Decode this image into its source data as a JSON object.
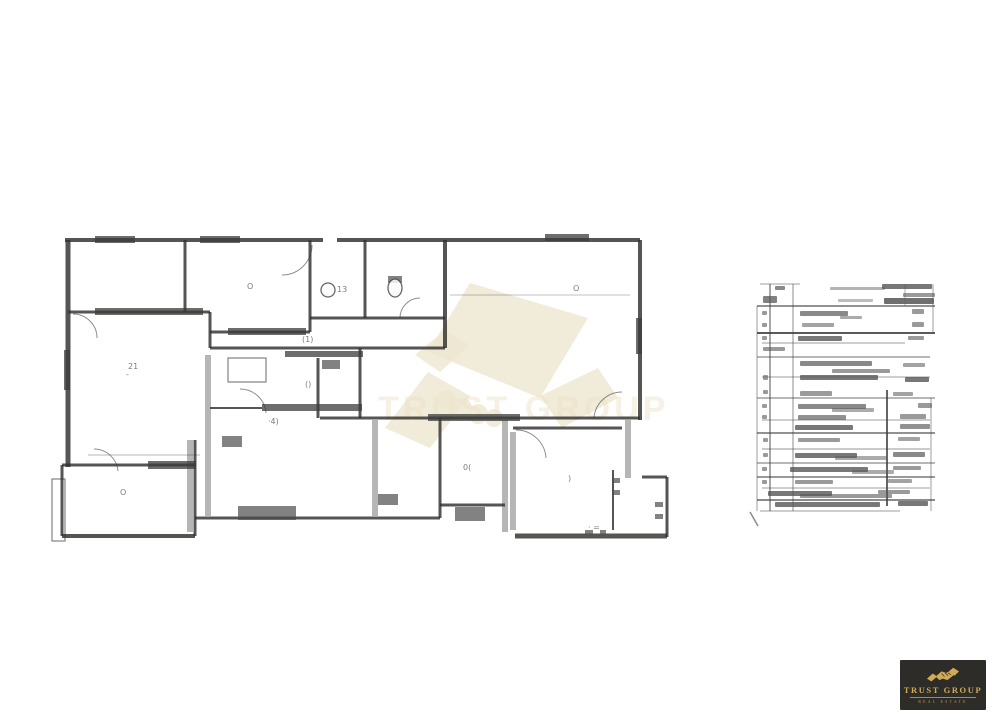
{
  "page": {
    "background": "#ffffff"
  },
  "logo": {
    "title": "TRUST GROUP",
    "subtitle": "REAL ESTATE",
    "bg": "#2d2c29",
    "gold": "#d2a955"
  },
  "watermark": {
    "color": "#f3ecd6",
    "text": "TRUST GROUP",
    "text_color": "#f0e5c6",
    "text_opacity": 0.45,
    "shape_opacity": 0.85,
    "polys": [
      [
        [
          470,
          283
        ],
        [
          588,
          318
        ],
        [
          540,
          398
        ],
        [
          428,
          352
        ]
      ],
      [
        [
          385,
          428
        ],
        [
          428,
          372
        ],
        [
          470,
          396
        ],
        [
          430,
          448
        ]
      ],
      [
        [
          540,
          396
        ],
        [
          598,
          368
        ],
        [
          618,
          398
        ],
        [
          562,
          428
        ]
      ],
      [
        [
          415,
          355
        ],
        [
          445,
          330
        ],
        [
          470,
          345
        ],
        [
          440,
          372
        ]
      ]
    ],
    "circles": [
      [
        447,
        400,
        10
      ],
      [
        462,
        408,
        10
      ],
      [
        478,
        414,
        10
      ],
      [
        494,
        418,
        9
      ]
    ]
  },
  "floor_plan": {
    "ink": "#2f2d2b",
    "gray": "#8f8f8f",
    "band_color": "#3a3a3a",
    "fixture_color": "#4a4a4a",
    "label_color": "#5a5a5a",
    "walls": [
      [
        65,
        240,
        323,
        240,
        4
      ],
      [
        337,
        240,
        640,
        240,
        4
      ],
      [
        640,
        240,
        640,
        420,
        4
      ],
      [
        320,
        418,
        640,
        418,
        3
      ],
      [
        513,
        428,
        622,
        428,
        3
      ],
      [
        642,
        477,
        667,
        477,
        3
      ],
      [
        667,
        477,
        667,
        537,
        3
      ],
      [
        515,
        536,
        667,
        536,
        5
      ],
      [
        613,
        470,
        613,
        530,
        2
      ],
      [
        195,
        518,
        440,
        518,
        3
      ],
      [
        440,
        505,
        505,
        505,
        3
      ],
      [
        440,
        418,
        440,
        518,
        3
      ],
      [
        68,
        240,
        68,
        467,
        5
      ],
      [
        62,
        465,
        195,
        465,
        3
      ],
      [
        62,
        465,
        62,
        536,
        3
      ],
      [
        62,
        536,
        195,
        536,
        4
      ],
      [
        195,
        440,
        195,
        536,
        3
      ],
      [
        185,
        240,
        185,
        312,
        3
      ],
      [
        68,
        312,
        210,
        312,
        3
      ],
      [
        210,
        312,
        210,
        348,
        3
      ],
      [
        310,
        240,
        310,
        332,
        3
      ],
      [
        210,
        332,
        310,
        332,
        3
      ],
      [
        365,
        240,
        365,
        318,
        3
      ],
      [
        310,
        318,
        365,
        318,
        3
      ],
      [
        365,
        318,
        445,
        318,
        3
      ],
      [
        445,
        240,
        445,
        348,
        4
      ],
      [
        210,
        348,
        445,
        348,
        3
      ],
      [
        318,
        358,
        318,
        418,
        3
      ],
      [
        360,
        348,
        360,
        418,
        3
      ],
      [
        210,
        408,
        262,
        408,
        2
      ],
      [
        450,
        295,
        630,
        295,
        1,
        0.3
      ],
      [
        88,
        455,
        200,
        455,
        1,
        0.35
      ]
    ],
    "gray_walls": [
      [
        208,
        355,
        208,
        516
      ],
      [
        375,
        420,
        375,
        516
      ],
      [
        505,
        420,
        505,
        532
      ],
      [
        513,
        432,
        513,
        530
      ],
      [
        628,
        420,
        628,
        478
      ],
      [
        190,
        440,
        190,
        532
      ]
    ],
    "bands": [
      [
        95,
        236,
        40,
        7
      ],
      [
        200,
        236,
        40,
        7
      ],
      [
        545,
        234,
        44,
        7
      ],
      [
        95,
        308,
        108,
        7
      ],
      [
        228,
        328,
        78,
        7
      ],
      [
        285,
        351,
        78,
        6
      ],
      [
        262,
        404,
        100,
        7
      ],
      [
        428,
        414,
        92,
        7
      ],
      [
        148,
        461,
        48,
        8
      ],
      [
        64,
        350,
        6,
        40
      ],
      [
        636,
        318,
        6,
        36
      ]
    ],
    "fixtures": [
      [
        238,
        506,
        58,
        14
      ],
      [
        455,
        507,
        30,
        14
      ],
      [
        378,
        494,
        20,
        11
      ],
      [
        222,
        436,
        20,
        11
      ],
      [
        388,
        276,
        14,
        7
      ],
      [
        322,
        360,
        18,
        9
      ],
      [
        612,
        478,
        8,
        5
      ],
      [
        612,
        490,
        8,
        5
      ],
      [
        655,
        502,
        8,
        5
      ],
      [
        655,
        514,
        8,
        5
      ],
      [
        585,
        530,
        8,
        4
      ],
      [
        600,
        530,
        6,
        4
      ]
    ],
    "ellipses": [
      [
        395,
        288,
        7,
        9
      ],
      [
        328,
        290,
        7,
        7
      ]
    ],
    "outline_rects": [
      [
        52,
        479,
        13,
        62
      ],
      [
        228,
        358,
        38,
        24
      ]
    ],
    "arcs": [
      [
        312,
        245,
        282,
        275,
        30
      ],
      [
        73,
        314,
        97,
        338,
        24
      ],
      [
        240,
        389,
        266,
        413,
        26
      ],
      [
        400,
        318,
        420,
        298,
        20
      ],
      [
        516,
        430,
        546,
        458,
        30
      ],
      [
        594,
        418,
        622,
        392,
        28
      ],
      [
        94,
        449,
        118,
        471,
        24
      ]
    ],
    "labels": [
      {
        "x": 128,
        "y": 369,
        "t": "21"
      },
      {
        "x": 126,
        "y": 377,
        "t": "-"
      },
      {
        "x": 247,
        "y": 289,
        "t": "O"
      },
      {
        "x": 337,
        "y": 292,
        "t": "13"
      },
      {
        "x": 573,
        "y": 291,
        "t": "O"
      },
      {
        "x": 463,
        "y": 470,
        "t": "0("
      },
      {
        "x": 568,
        "y": 481,
        "t": ")"
      },
      {
        "x": 120,
        "y": 495,
        "t": "O"
      },
      {
        "x": 305,
        "y": 387,
        "t": "()"
      },
      {
        "x": 268,
        "y": 424,
        "t": "·4)"
      },
      {
        "x": 588,
        "y": 530,
        "t": "· ="
      },
      {
        "x": 302,
        "y": 342,
        "t": "(1)"
      }
    ]
  },
  "legend_table": {
    "line_color": "#3c3c3c",
    "bar_color": "#555555",
    "h_rules": [
      [
        284,
        760,
        800,
        1,
        0.5
      ],
      [
        306,
        757,
        935,
        1.5,
        0.75
      ],
      [
        333,
        757,
        935,
        2,
        0.85
      ],
      [
        343,
        762,
        905,
        1,
        0.5
      ],
      [
        357,
        757,
        930,
        1.2,
        0.6
      ],
      [
        377,
        762,
        930,
        1,
        0.5
      ],
      [
        398,
        757,
        935,
        1.2,
        0.6
      ],
      [
        420,
        762,
        930,
        1,
        0.5
      ],
      [
        433,
        757,
        935,
        1.5,
        0.75
      ],
      [
        449,
        762,
        930,
        1,
        0.55
      ],
      [
        463,
        757,
        935,
        1.2,
        0.6
      ],
      [
        477,
        757,
        935,
        1.5,
        0.7
      ],
      [
        488,
        762,
        930,
        1,
        0.5
      ],
      [
        500,
        757,
        935,
        1.5,
        0.8
      ],
      [
        511,
        760,
        900,
        1,
        0.5
      ]
    ],
    "v_rules": [
      [
        757,
        306,
        511,
        1,
        0.5
      ],
      [
        770,
        284,
        511,
        1.3,
        0.7
      ],
      [
        793,
        284,
        511,
        1,
        0.6
      ],
      [
        887,
        390,
        506,
        2,
        0.8
      ],
      [
        933,
        284,
        333,
        1,
        0.5
      ],
      [
        931,
        398,
        511,
        1,
        0.5
      ],
      [
        905,
        284,
        306,
        1,
        0.4
      ]
    ],
    "bars": [
      [
        775,
        286,
        10,
        4,
        0.7
      ],
      [
        830,
        287,
        55,
        3,
        0.45
      ],
      [
        882,
        284,
        50,
        5,
        0.8
      ],
      [
        903,
        293,
        32,
        4,
        0.6
      ],
      [
        763,
        296,
        14,
        7,
        0.75
      ],
      [
        838,
        299,
        35,
        3,
        0.4
      ],
      [
        884,
        298,
        50,
        6,
        0.85
      ],
      [
        800,
        311,
        48,
        5,
        0.7
      ],
      [
        840,
        316,
        22,
        3,
        0.5
      ],
      [
        912,
        309,
        12,
        5,
        0.6
      ],
      [
        802,
        323,
        32,
        4,
        0.55
      ],
      [
        912,
        322,
        12,
        5,
        0.6
      ],
      [
        798,
        336,
        44,
        5,
        0.8
      ],
      [
        908,
        336,
        16,
        4,
        0.6
      ],
      [
        763,
        347,
        22,
        4,
        0.6
      ],
      [
        800,
        361,
        72,
        5,
        0.7
      ],
      [
        832,
        369,
        58,
        4,
        0.6
      ],
      [
        903,
        363,
        22,
        4,
        0.55
      ],
      [
        800,
        375,
        78,
        5,
        0.8
      ],
      [
        905,
        377,
        24,
        5,
        0.8
      ],
      [
        800,
        391,
        32,
        5,
        0.6
      ],
      [
        893,
        392,
        20,
        4,
        0.55
      ],
      [
        798,
        404,
        68,
        5,
        0.7
      ],
      [
        832,
        408,
        42,
        4,
        0.5
      ],
      [
        918,
        403,
        14,
        5,
        0.6
      ],
      [
        798,
        415,
        48,
        5,
        0.65
      ],
      [
        900,
        414,
        26,
        5,
        0.6
      ],
      [
        795,
        425,
        58,
        5,
        0.8
      ],
      [
        900,
        424,
        30,
        5,
        0.65
      ],
      [
        798,
        438,
        42,
        4,
        0.6
      ],
      [
        898,
        437,
        22,
        4,
        0.55
      ],
      [
        795,
        453,
        62,
        5,
        0.8
      ],
      [
        835,
        456,
        52,
        4,
        0.5
      ],
      [
        893,
        452,
        32,
        5,
        0.7
      ],
      [
        790,
        467,
        78,
        5,
        0.8
      ],
      [
        852,
        470,
        42,
        4,
        0.5
      ],
      [
        893,
        466,
        28,
        4,
        0.6
      ],
      [
        795,
        480,
        38,
        4,
        0.6
      ],
      [
        888,
        479,
        24,
        4,
        0.55
      ],
      [
        768,
        491,
        64,
        5,
        0.8
      ],
      [
        800,
        494,
        92,
        4,
        0.6
      ],
      [
        878,
        490,
        32,
        4,
        0.6
      ],
      [
        775,
        502,
        105,
        5,
        0.8
      ],
      [
        898,
        501,
        30,
        5,
        0.8
      ],
      [
        762,
        311,
        5,
        4,
        0.6
      ],
      [
        762,
        323,
        5,
        4,
        0.6
      ],
      [
        762,
        336,
        5,
        4,
        0.6
      ],
      [
        763,
        375,
        5,
        5,
        0.6
      ],
      [
        763,
        390,
        5,
        4,
        0.6
      ],
      [
        762,
        404,
        5,
        4,
        0.6
      ],
      [
        762,
        415,
        5,
        4,
        0.6
      ],
      [
        763,
        438,
        5,
        4,
        0.6
      ],
      [
        763,
        453,
        5,
        4,
        0.6
      ],
      [
        762,
        467,
        5,
        4,
        0.6
      ],
      [
        762,
        480,
        5,
        4,
        0.6
      ]
    ],
    "slash": [
      750,
      512,
      758,
      526
    ]
  }
}
